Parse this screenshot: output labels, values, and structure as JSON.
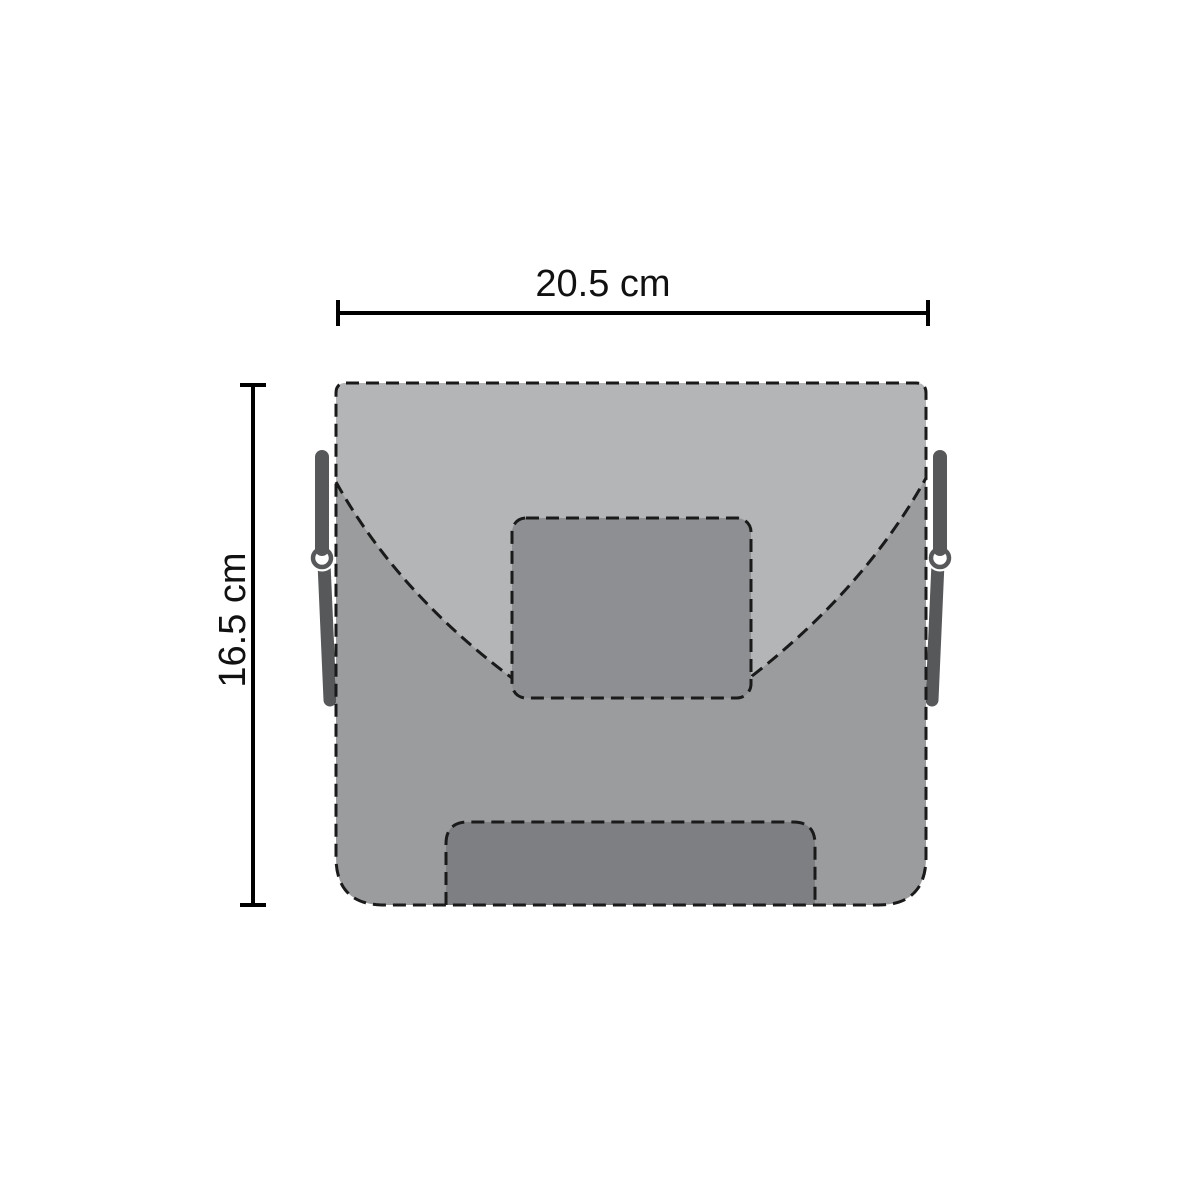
{
  "diagram": {
    "dimensions": {
      "width": {
        "label": "20.5 cm",
        "value": 20.5,
        "unit": "cm"
      },
      "height": {
        "label": "16.5 cm",
        "value": 16.5,
        "unit": "cm"
      }
    },
    "colors": {
      "background": "#ffffff",
      "flap": "#b4b5b6",
      "body": "#9b9c9e",
      "clasp_patch": "#8d8f92",
      "bottom_panel": "#7d7f82",
      "strap": "#57585a",
      "ring_halo": "#ffffff",
      "outline": "#1a1a1a",
      "dimension_line": "#000000"
    }
  }
}
